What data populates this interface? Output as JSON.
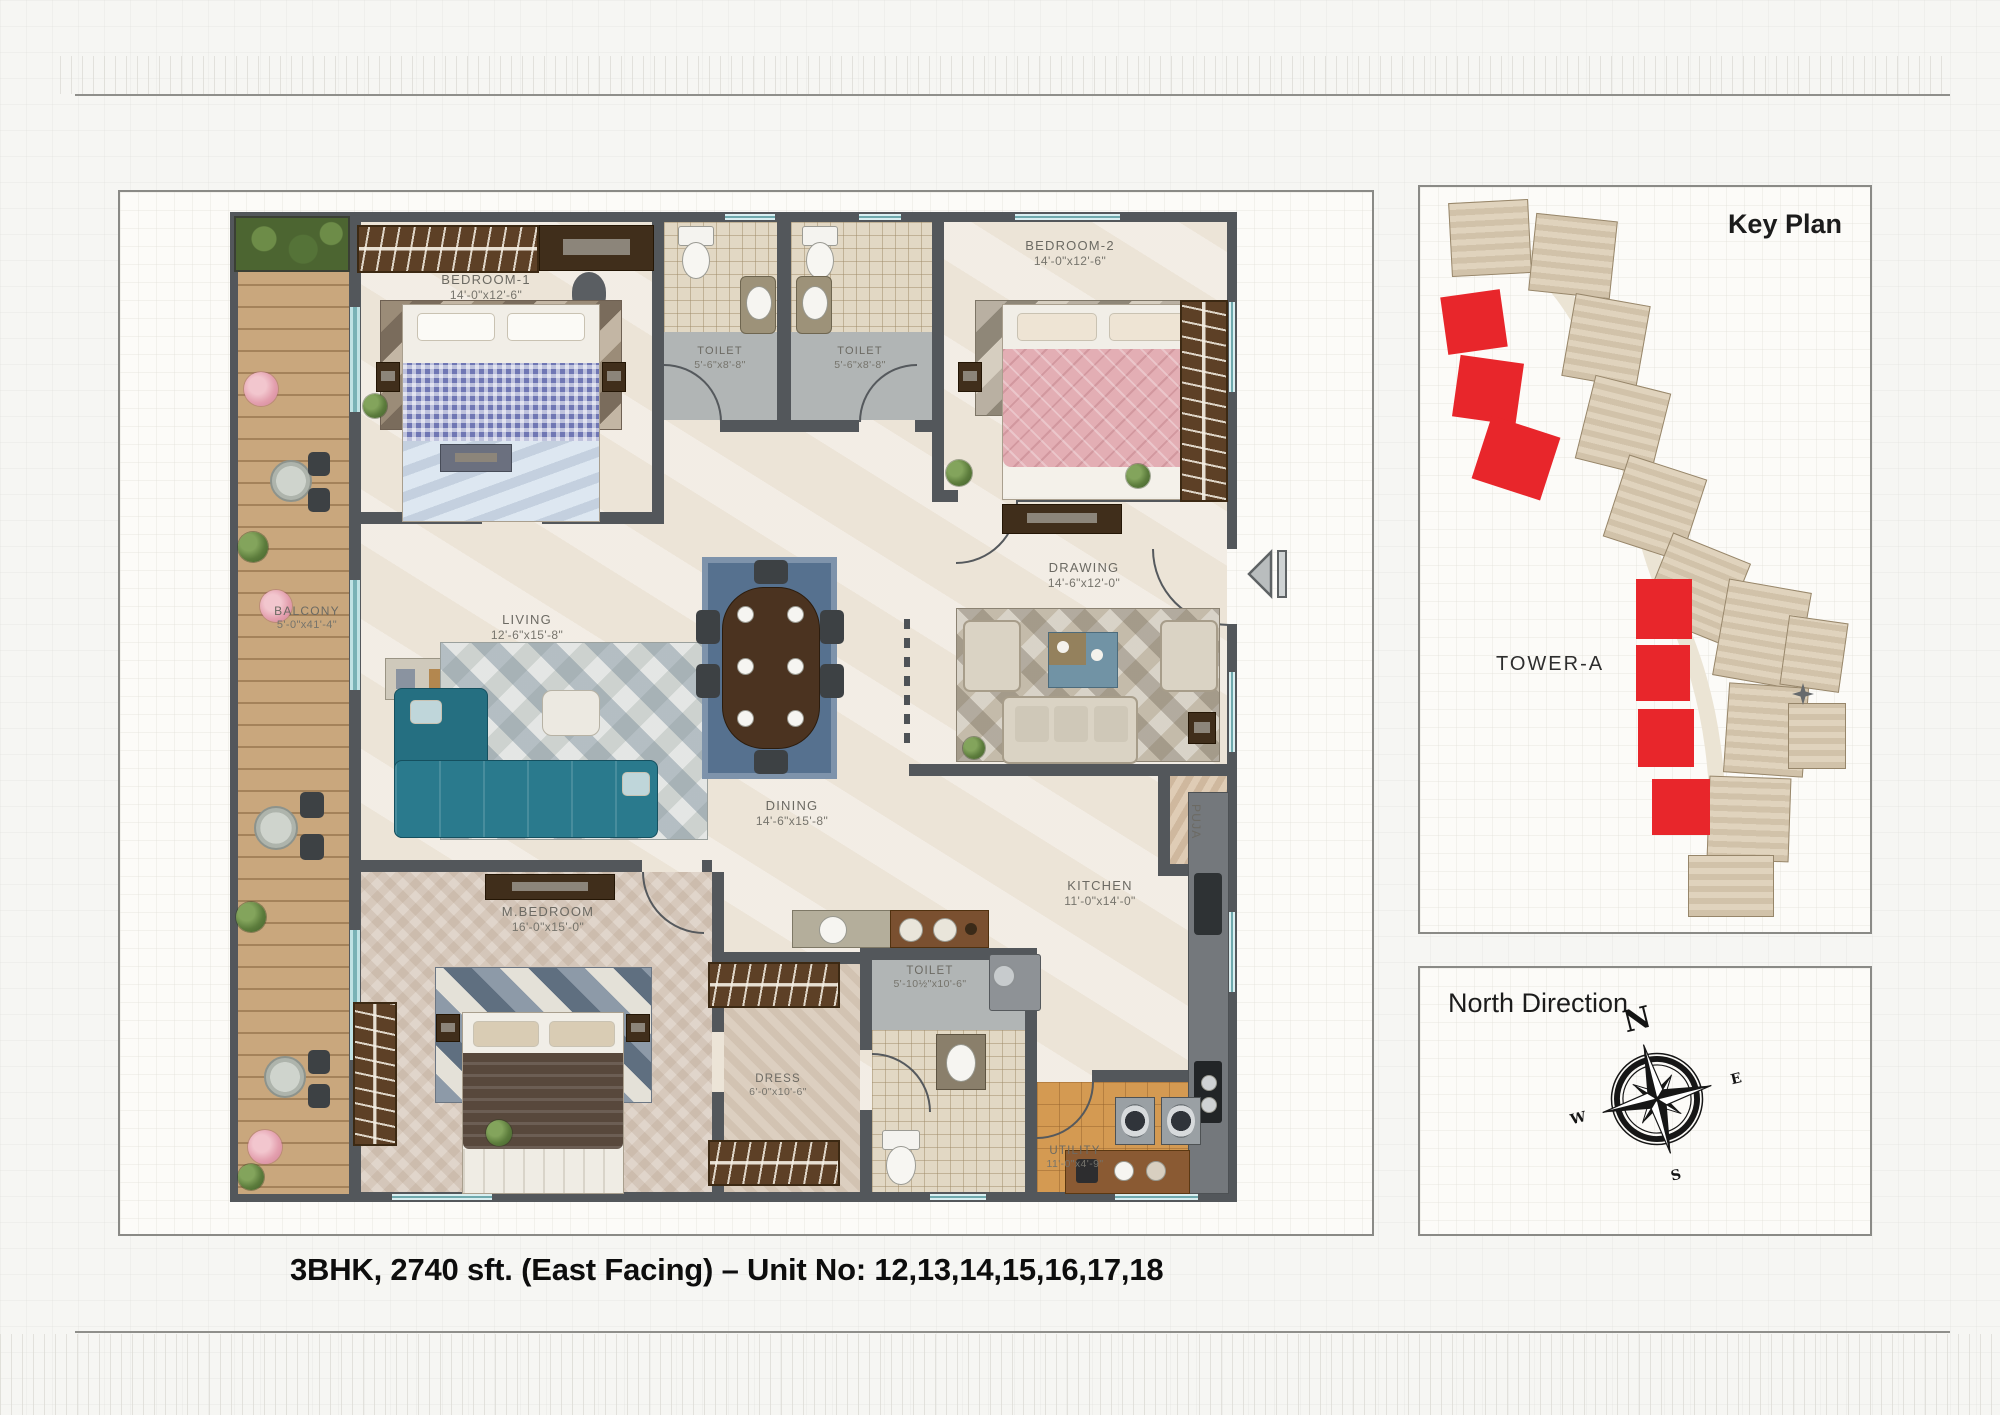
{
  "page": {
    "caption": "3BHK, 2740 sft. (East Facing) – Unit No: 12,13,14,15,16,17,18"
  },
  "floor_plan": {
    "rooms": [
      {
        "id": "bedroom1",
        "name": "BEDROOM-1",
        "dims": "14'-0\"x12'-6\""
      },
      {
        "id": "toilet1",
        "name": "TOILET",
        "dims": "5'-6\"x8'-8\""
      },
      {
        "id": "toilet2",
        "name": "TOILET",
        "dims": "5'-6\"x8'-8\""
      },
      {
        "id": "bedroom2",
        "name": "BEDROOM-2",
        "dims": "14'-0\"x12'-6\""
      },
      {
        "id": "drawing",
        "name": "DRAWING",
        "dims": "14'-6\"x12'-0\""
      },
      {
        "id": "living",
        "name": "LIVING",
        "dims": "12'-6\"x15'-8\""
      },
      {
        "id": "balcony",
        "name": "BALCONY",
        "dims": "5'-0\"x41'-4\""
      },
      {
        "id": "dining",
        "name": "DINING",
        "dims": "14'-6\"x15'-8\""
      },
      {
        "id": "mbedroom",
        "name": "M.BEDROOM",
        "dims": "16'-0\"x15'-0\""
      },
      {
        "id": "dress",
        "name": "DRESS",
        "dims": "6'-0\"x10'-6\""
      },
      {
        "id": "toilet3",
        "name": "TOILET",
        "dims": "5'-10½\"x10'-6\""
      },
      {
        "id": "kitchen",
        "name": "KITCHEN",
        "dims": "11'-0\"x14'-0\""
      },
      {
        "id": "puja",
        "name": "PUJA",
        "dims": ""
      },
      {
        "id": "utility",
        "name": "UTILITY",
        "dims": "11'-0\"x4'-9\""
      }
    ]
  },
  "key_plan": {
    "title": "Key Plan",
    "tower_label": "TOWER-A",
    "highlighted_units_count": 7,
    "colors": {
      "highlight_red": "#e8262b",
      "building_tan": "#e0d3bd"
    }
  },
  "north_panel": {
    "title": "North Direction",
    "compass": {
      "n": "N",
      "e": "E",
      "s": "S",
      "w": "W"
    }
  },
  "colors": {
    "wall": "#53575b",
    "sofa_teal": "#27778a",
    "balcony_wood": "#c9a77d"
  }
}
